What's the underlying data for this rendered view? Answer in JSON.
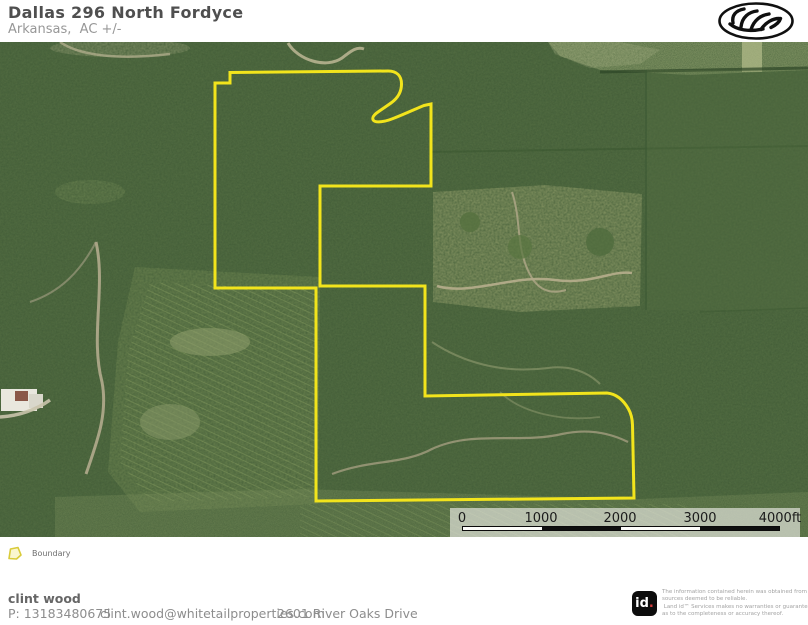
{
  "header": {
    "title": "Dallas 296 North Fordyce",
    "subtitle": "Arkansas,  AC +/-"
  },
  "map": {
    "boundary_color": "#f2e41c",
    "scalebar": {
      "labels": [
        "0",
        "1000",
        "2000",
        "3000",
        "4000ft"
      ]
    }
  },
  "legend": {
    "items": [
      {
        "label": "Boundary",
        "color": "#f2e41c"
      }
    ]
  },
  "footer": {
    "agent_name": "clint wood",
    "phone": "P: 13183480675",
    "email": "clint.wood@whitetailproperties.com",
    "address": "2601 River Oaks Drive",
    "brand": {
      "id_text": "id",
      "dot": "."
    },
    "disclaimer_lines": [
      "The information contained herein was obtained from",
      "sources deemed to be reliable.",
      " Land id™ Services makes no warranties or guarantees",
      "as to the completeness or accuracy thereof."
    ]
  }
}
